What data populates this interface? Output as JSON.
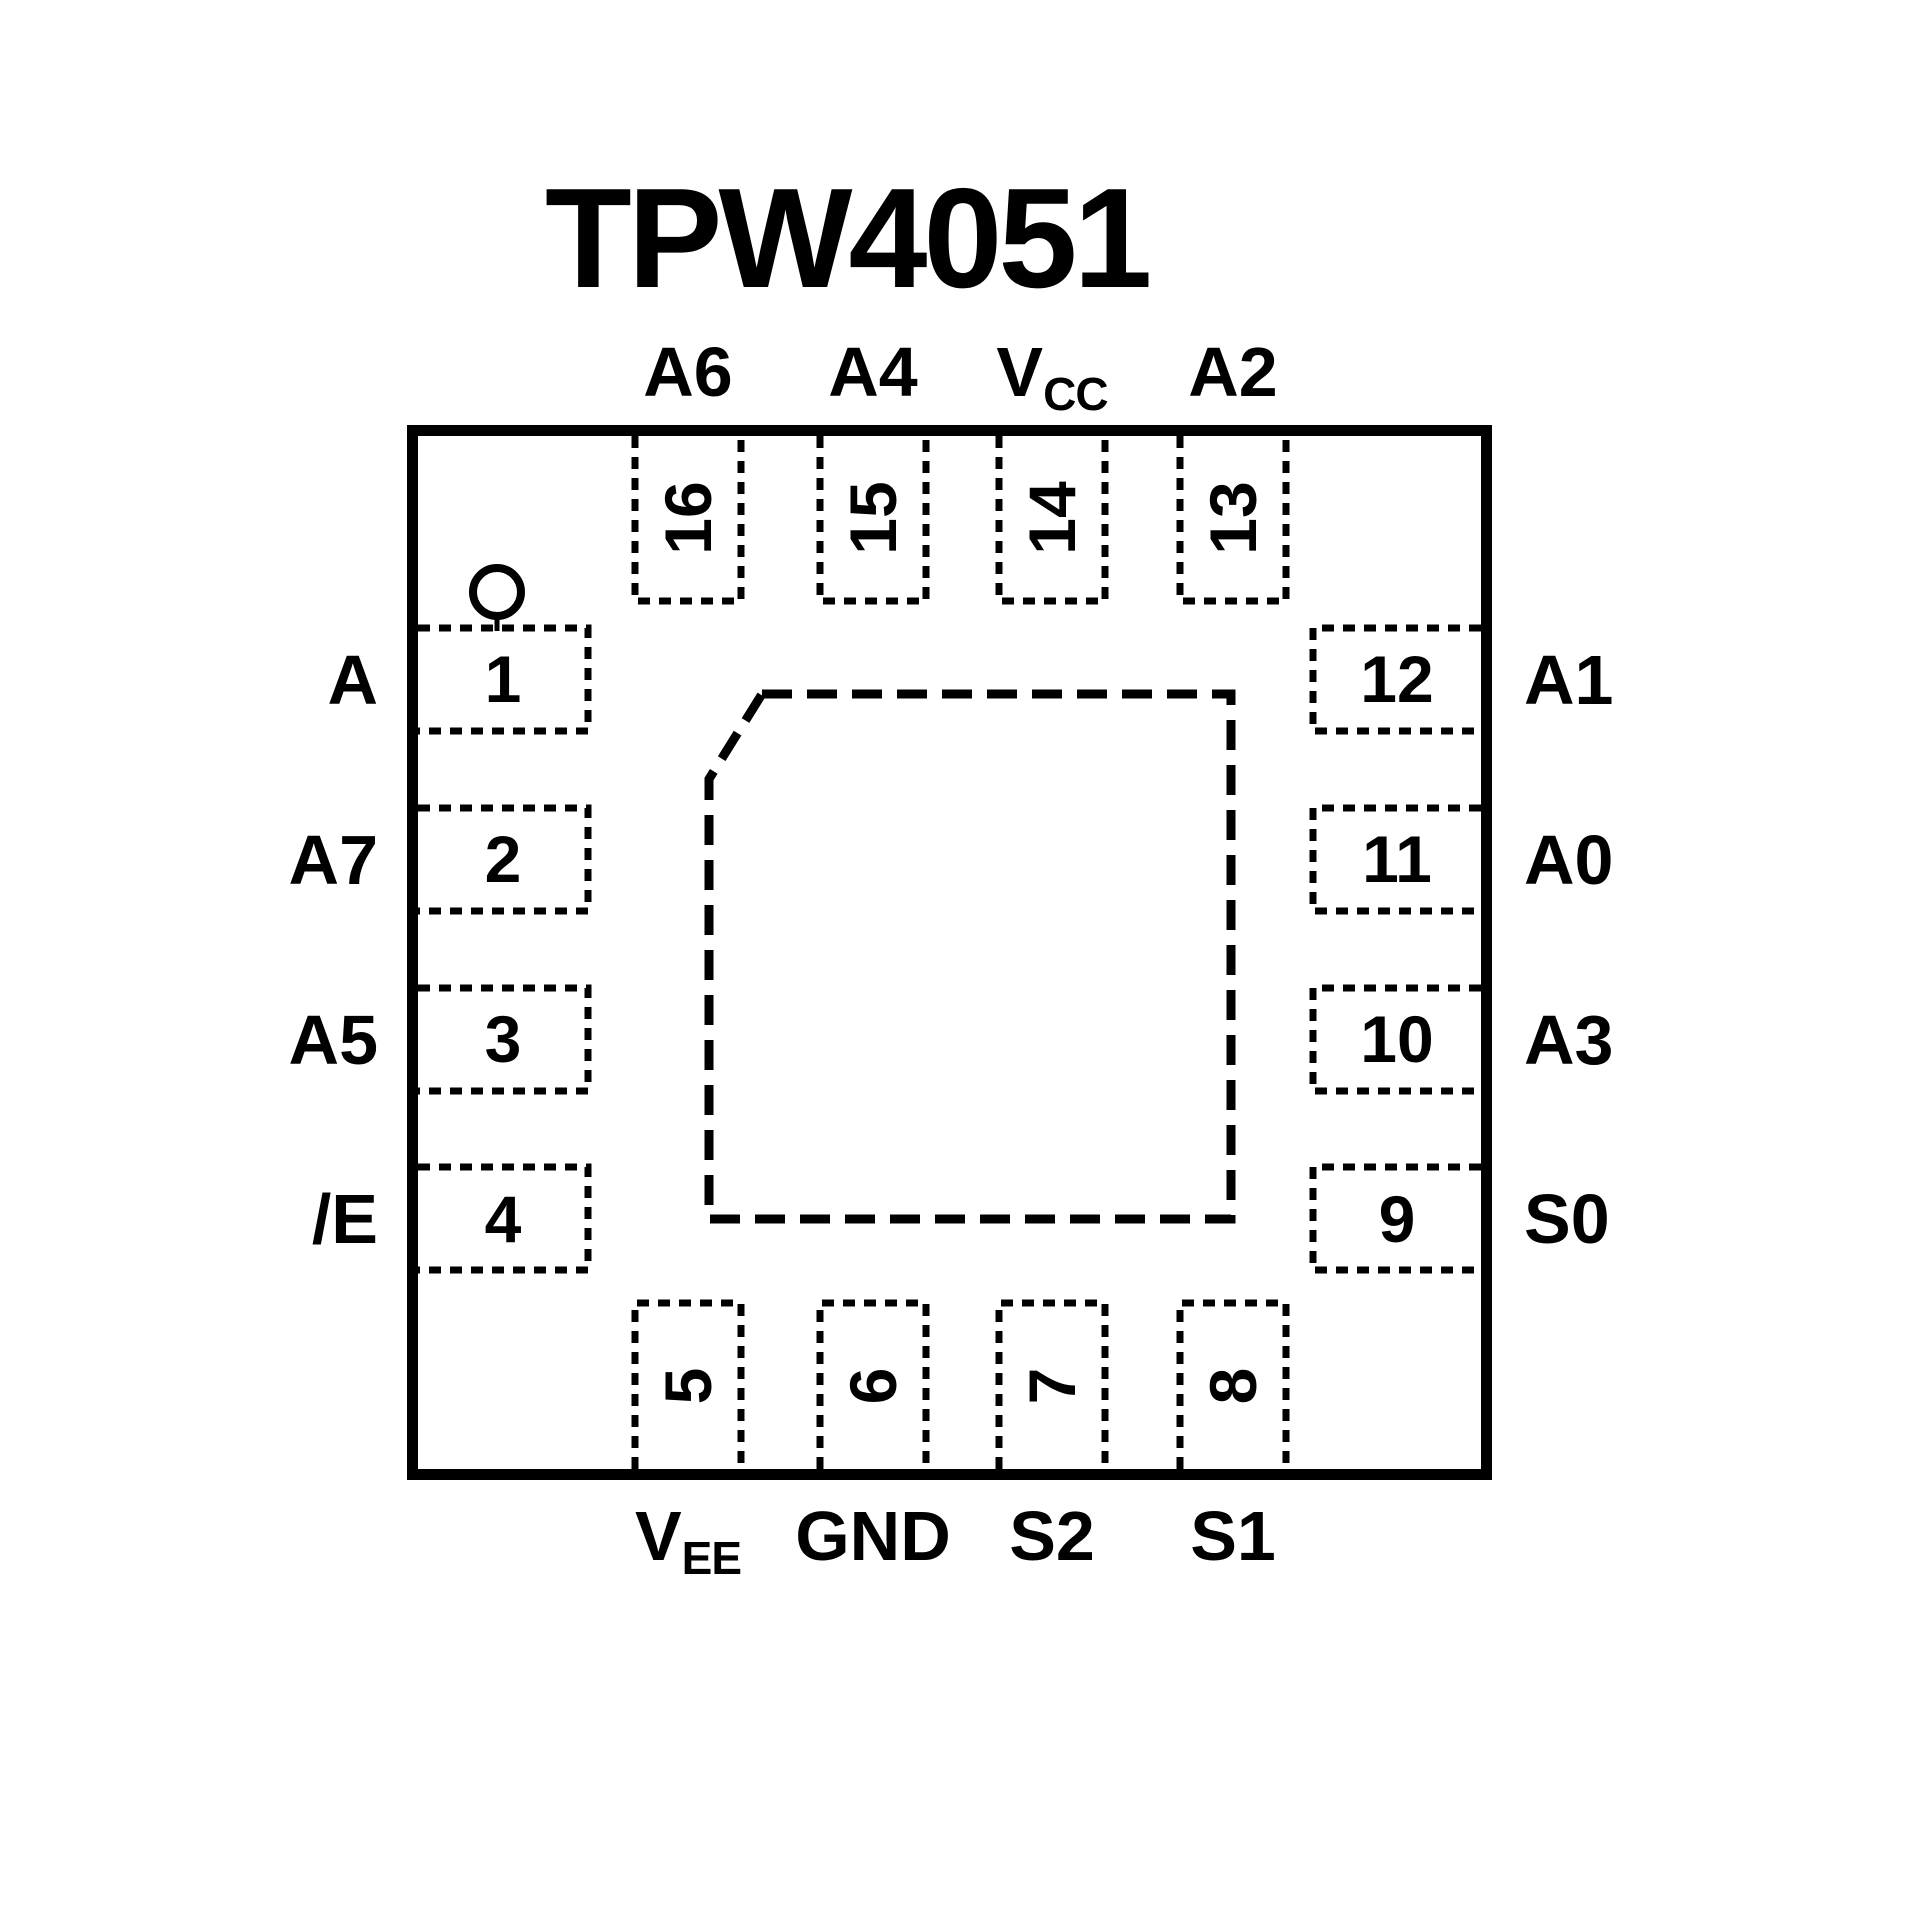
{
  "title": "TPW4051",
  "colors": {
    "ink": "#000000",
    "background": "#ffffff"
  },
  "pins": {
    "top": [
      {
        "number": "16",
        "label": "A6",
        "sub": ""
      },
      {
        "number": "15",
        "label": "A4",
        "sub": ""
      },
      {
        "number": "14",
        "label": "V",
        "sub": "CC"
      },
      {
        "number": "13",
        "label": "A2",
        "sub": ""
      }
    ],
    "right": [
      {
        "number": "12",
        "label": "A1",
        "sub": ""
      },
      {
        "number": "11",
        "label": "A0",
        "sub": ""
      },
      {
        "number": "10",
        "label": "A3",
        "sub": ""
      },
      {
        "number": "9",
        "label": "S0",
        "sub": ""
      }
    ],
    "bottom": [
      {
        "number": "5",
        "label": "V",
        "sub": "EE"
      },
      {
        "number": "6",
        "label": "GND",
        "sub": ""
      },
      {
        "number": "7",
        "label": "S2",
        "sub": ""
      },
      {
        "number": "8",
        "label": "S1",
        "sub": ""
      }
    ],
    "left": [
      {
        "number": "1",
        "label": "A",
        "sub": ""
      },
      {
        "number": "2",
        "label": "A7",
        "sub": ""
      },
      {
        "number": "3",
        "label": "A5",
        "sub": ""
      },
      {
        "number": "4",
        "label": "/E",
        "sub": ""
      }
    ]
  }
}
